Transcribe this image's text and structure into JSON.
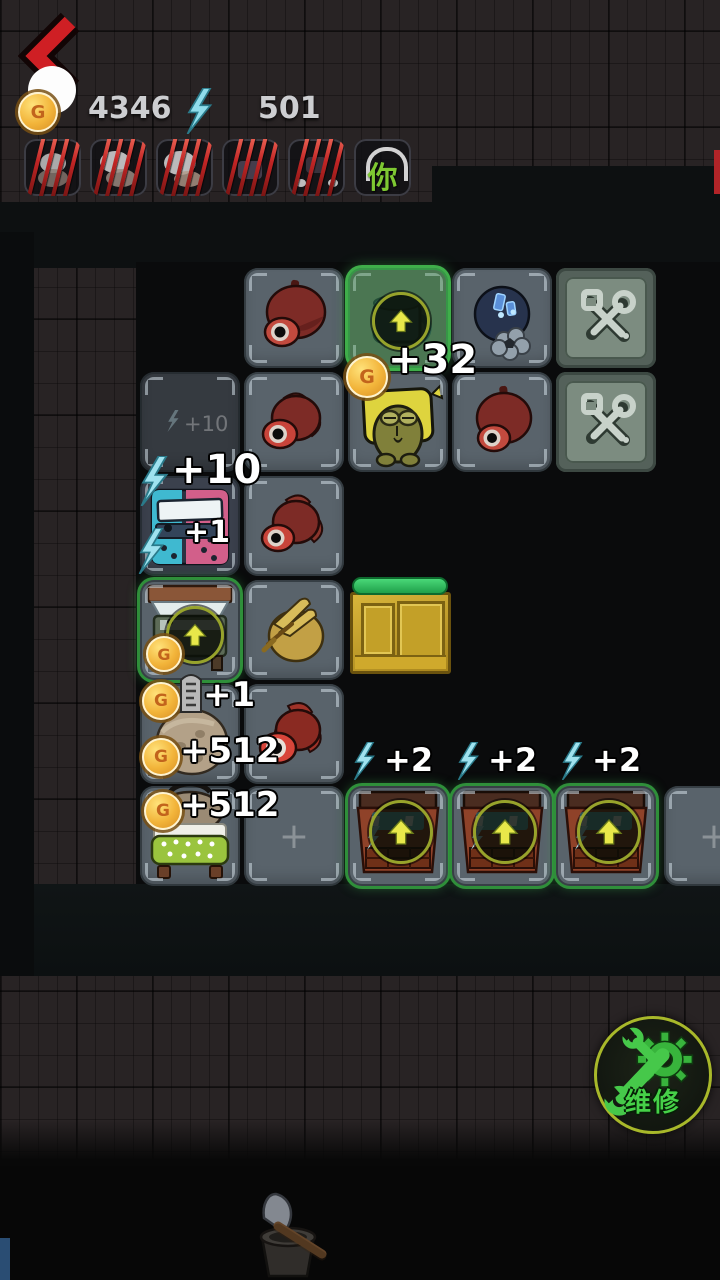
{
  "hud": {
    "gold": "4346",
    "energy": "501"
  },
  "icons": {
    "coin_letter": "G"
  },
  "roster": {
    "active_glyph": "你"
  },
  "labels": {
    "mug_bonus": "+32",
    "battery_bonus": "+10",
    "battery_ghost": "+10",
    "battery_count": "+1",
    "grave_bonus": "+1",
    "rock_gold": "+512",
    "bed_gold": "+512",
    "generator_bonus": "+2",
    "empty_plus": "+"
  },
  "repair": {
    "label": "维修"
  }
}
